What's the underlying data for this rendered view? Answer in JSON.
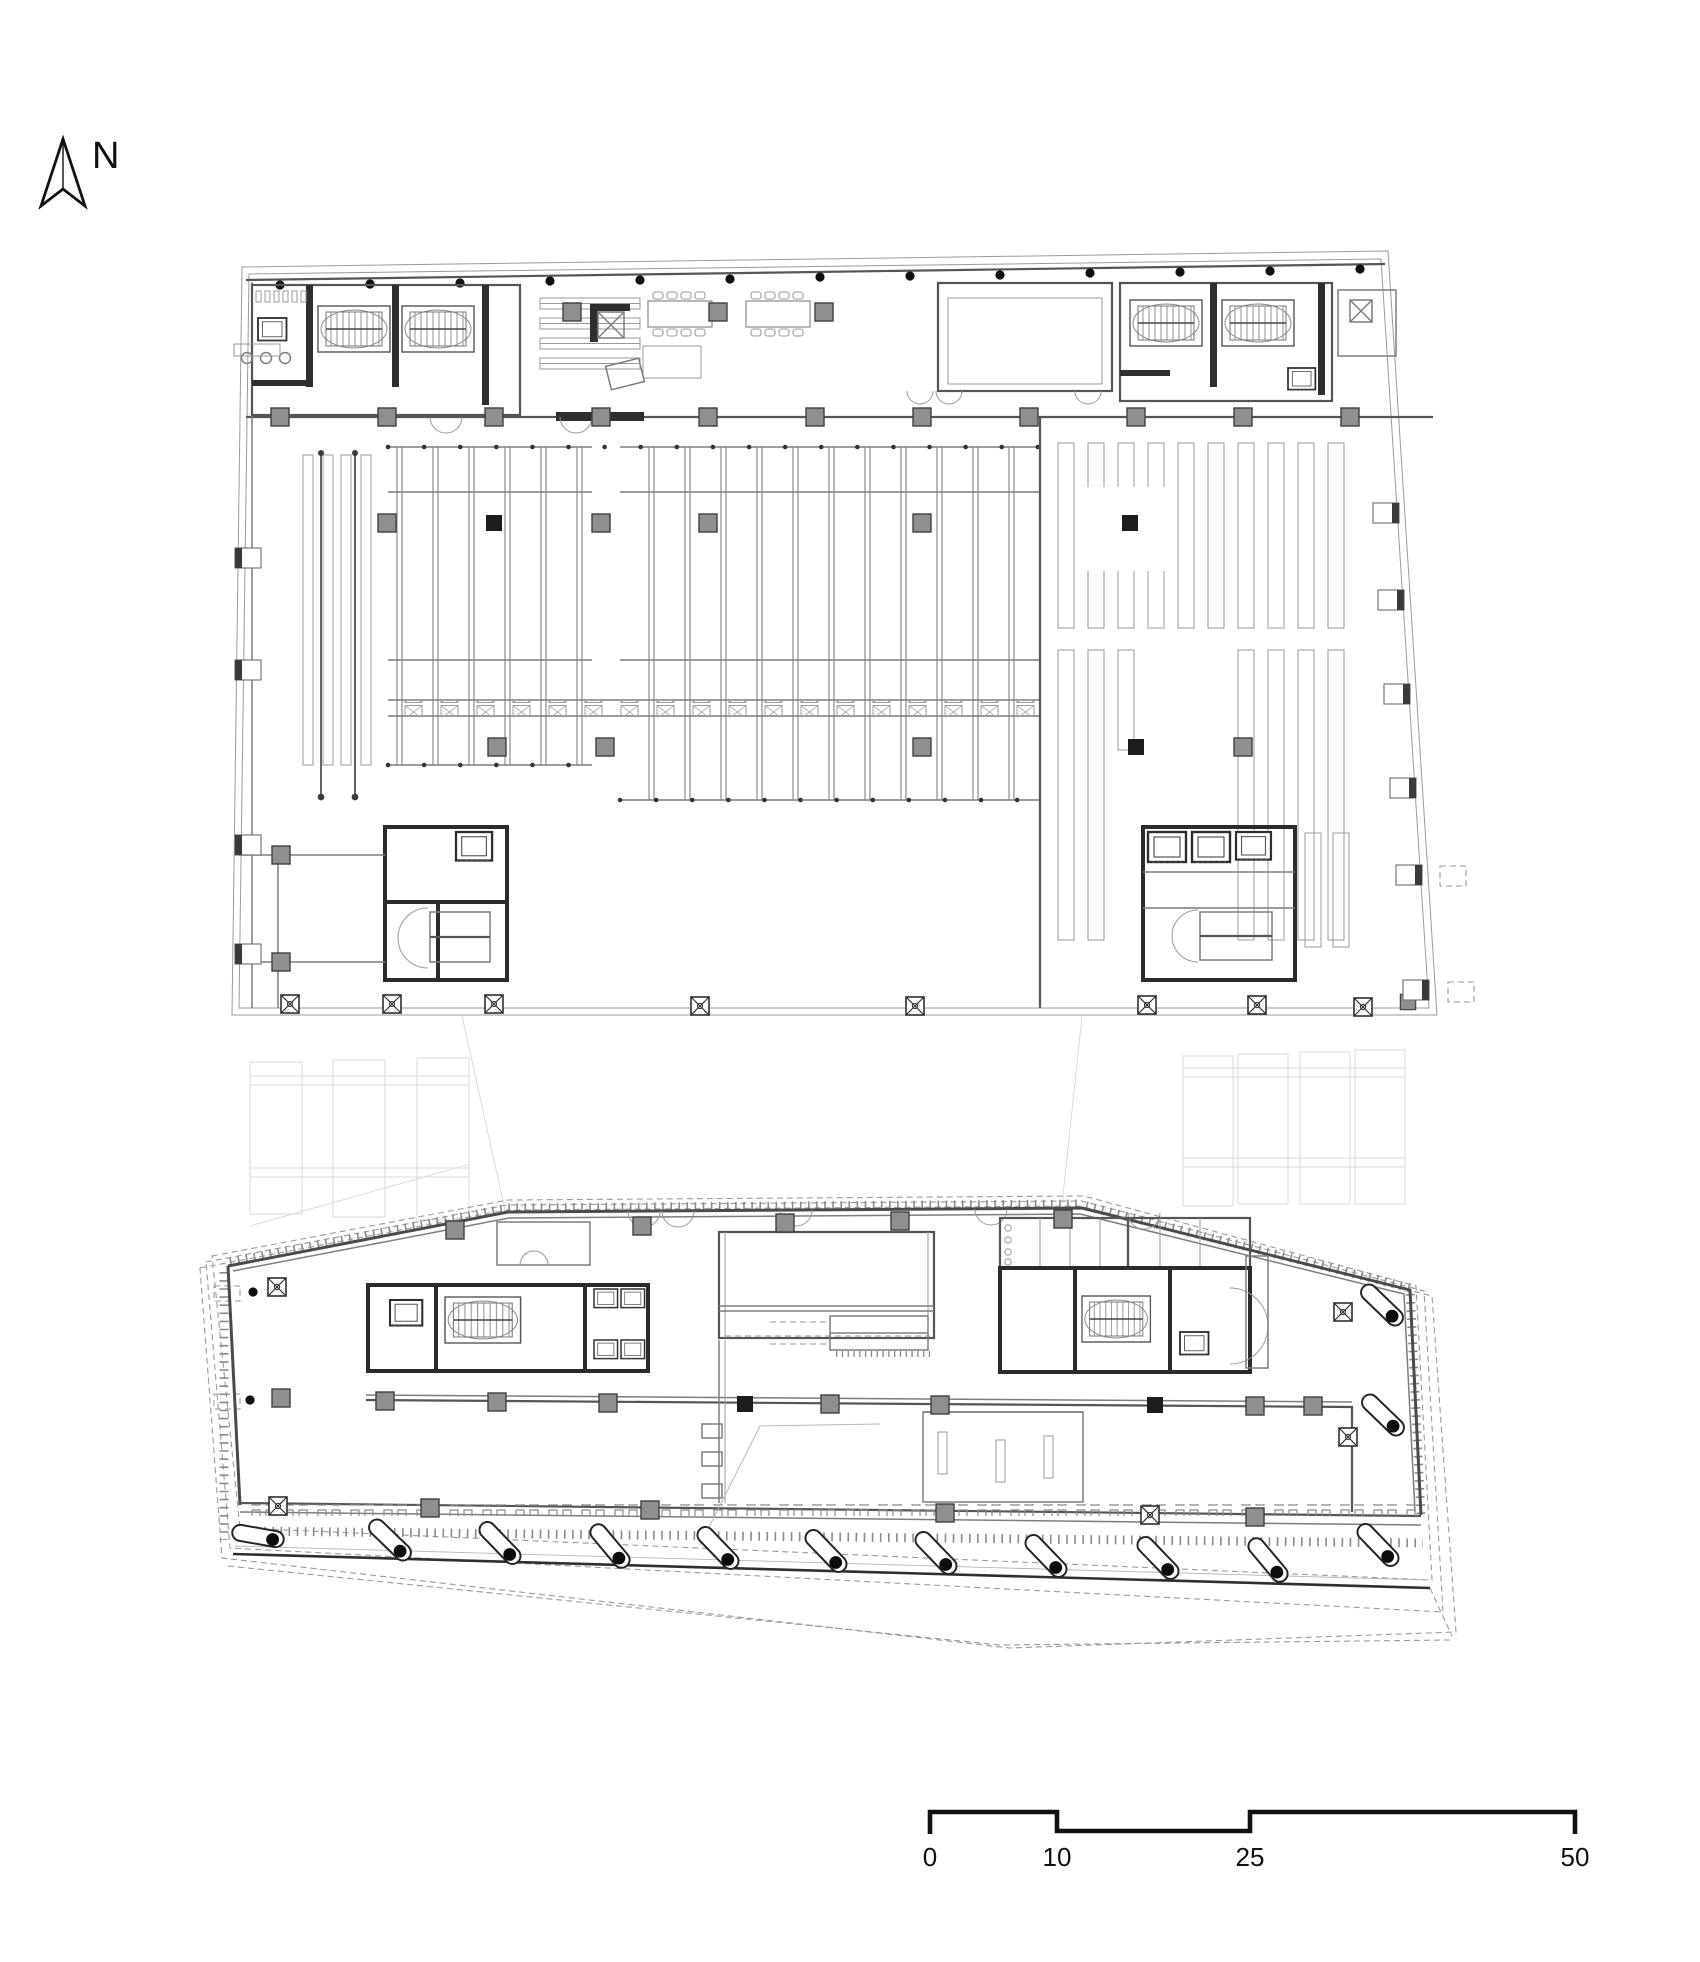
{
  "north_arrow": {
    "label": "N",
    "icon": "north-arrow-icon"
  },
  "scale_bar": {
    "ticks": [
      {
        "label": "0"
      },
      {
        "label": "10"
      },
      {
        "label": "25"
      },
      {
        "label": "50"
      }
    ]
  },
  "colors": {
    "background": "#ffffff",
    "ink": "#111111",
    "wall_dark": "#2b2b2b",
    "wall_mid": "#555555",
    "line_light": "#9a9a9a",
    "column_fill": "#8f8f8f",
    "ghost": "#cccccc"
  }
}
